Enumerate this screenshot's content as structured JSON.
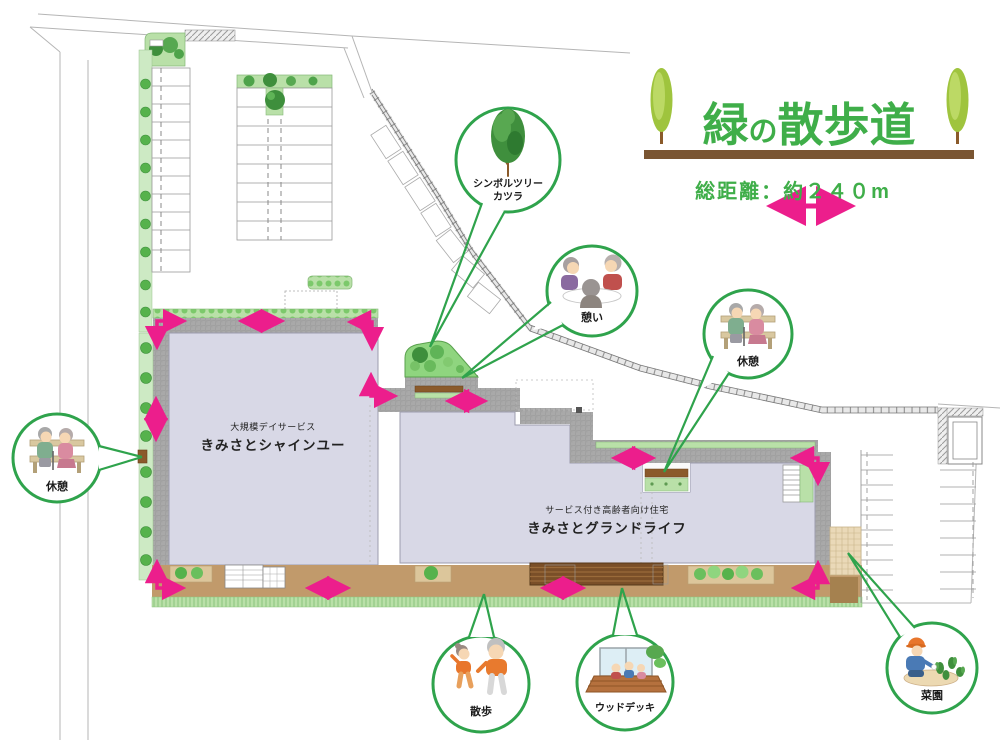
{
  "title": {
    "part_green": "緑",
    "part_no": "の",
    "part_walk": "散歩道",
    "distance": "総距離：約２４０m"
  },
  "buildings": {
    "day_service": {
      "category": "大規模デイサービス",
      "name": "きみさとシャインユー"
    },
    "senior_housing": {
      "category": "サービス付き高齢者向け住宅",
      "name": "きみさとグランドライフ"
    }
  },
  "callouts": {
    "symbol_tree": {
      "line1": "シンボルツリー",
      "line2": "カツラ"
    },
    "ikoi": {
      "label": "憩い"
    },
    "kyukei_right": {
      "label": "休憩"
    },
    "kyukei_left": {
      "label": "休憩"
    },
    "sanpo": {
      "label": "散歩"
    },
    "wood_deck": {
      "label": "ウッドデッキ"
    },
    "saien": {
      "label": "菜園"
    }
  },
  "colors": {
    "accent_green": "#3fae49",
    "callout_ring_green": "#2fa34c",
    "path_pink": "#ec1e8c",
    "bar_brown": "#7a5532",
    "walkway_brown": "#c19a6b",
    "tile_gray": "#a9a9a9",
    "building_lavender": "#d8d8e6"
  }
}
